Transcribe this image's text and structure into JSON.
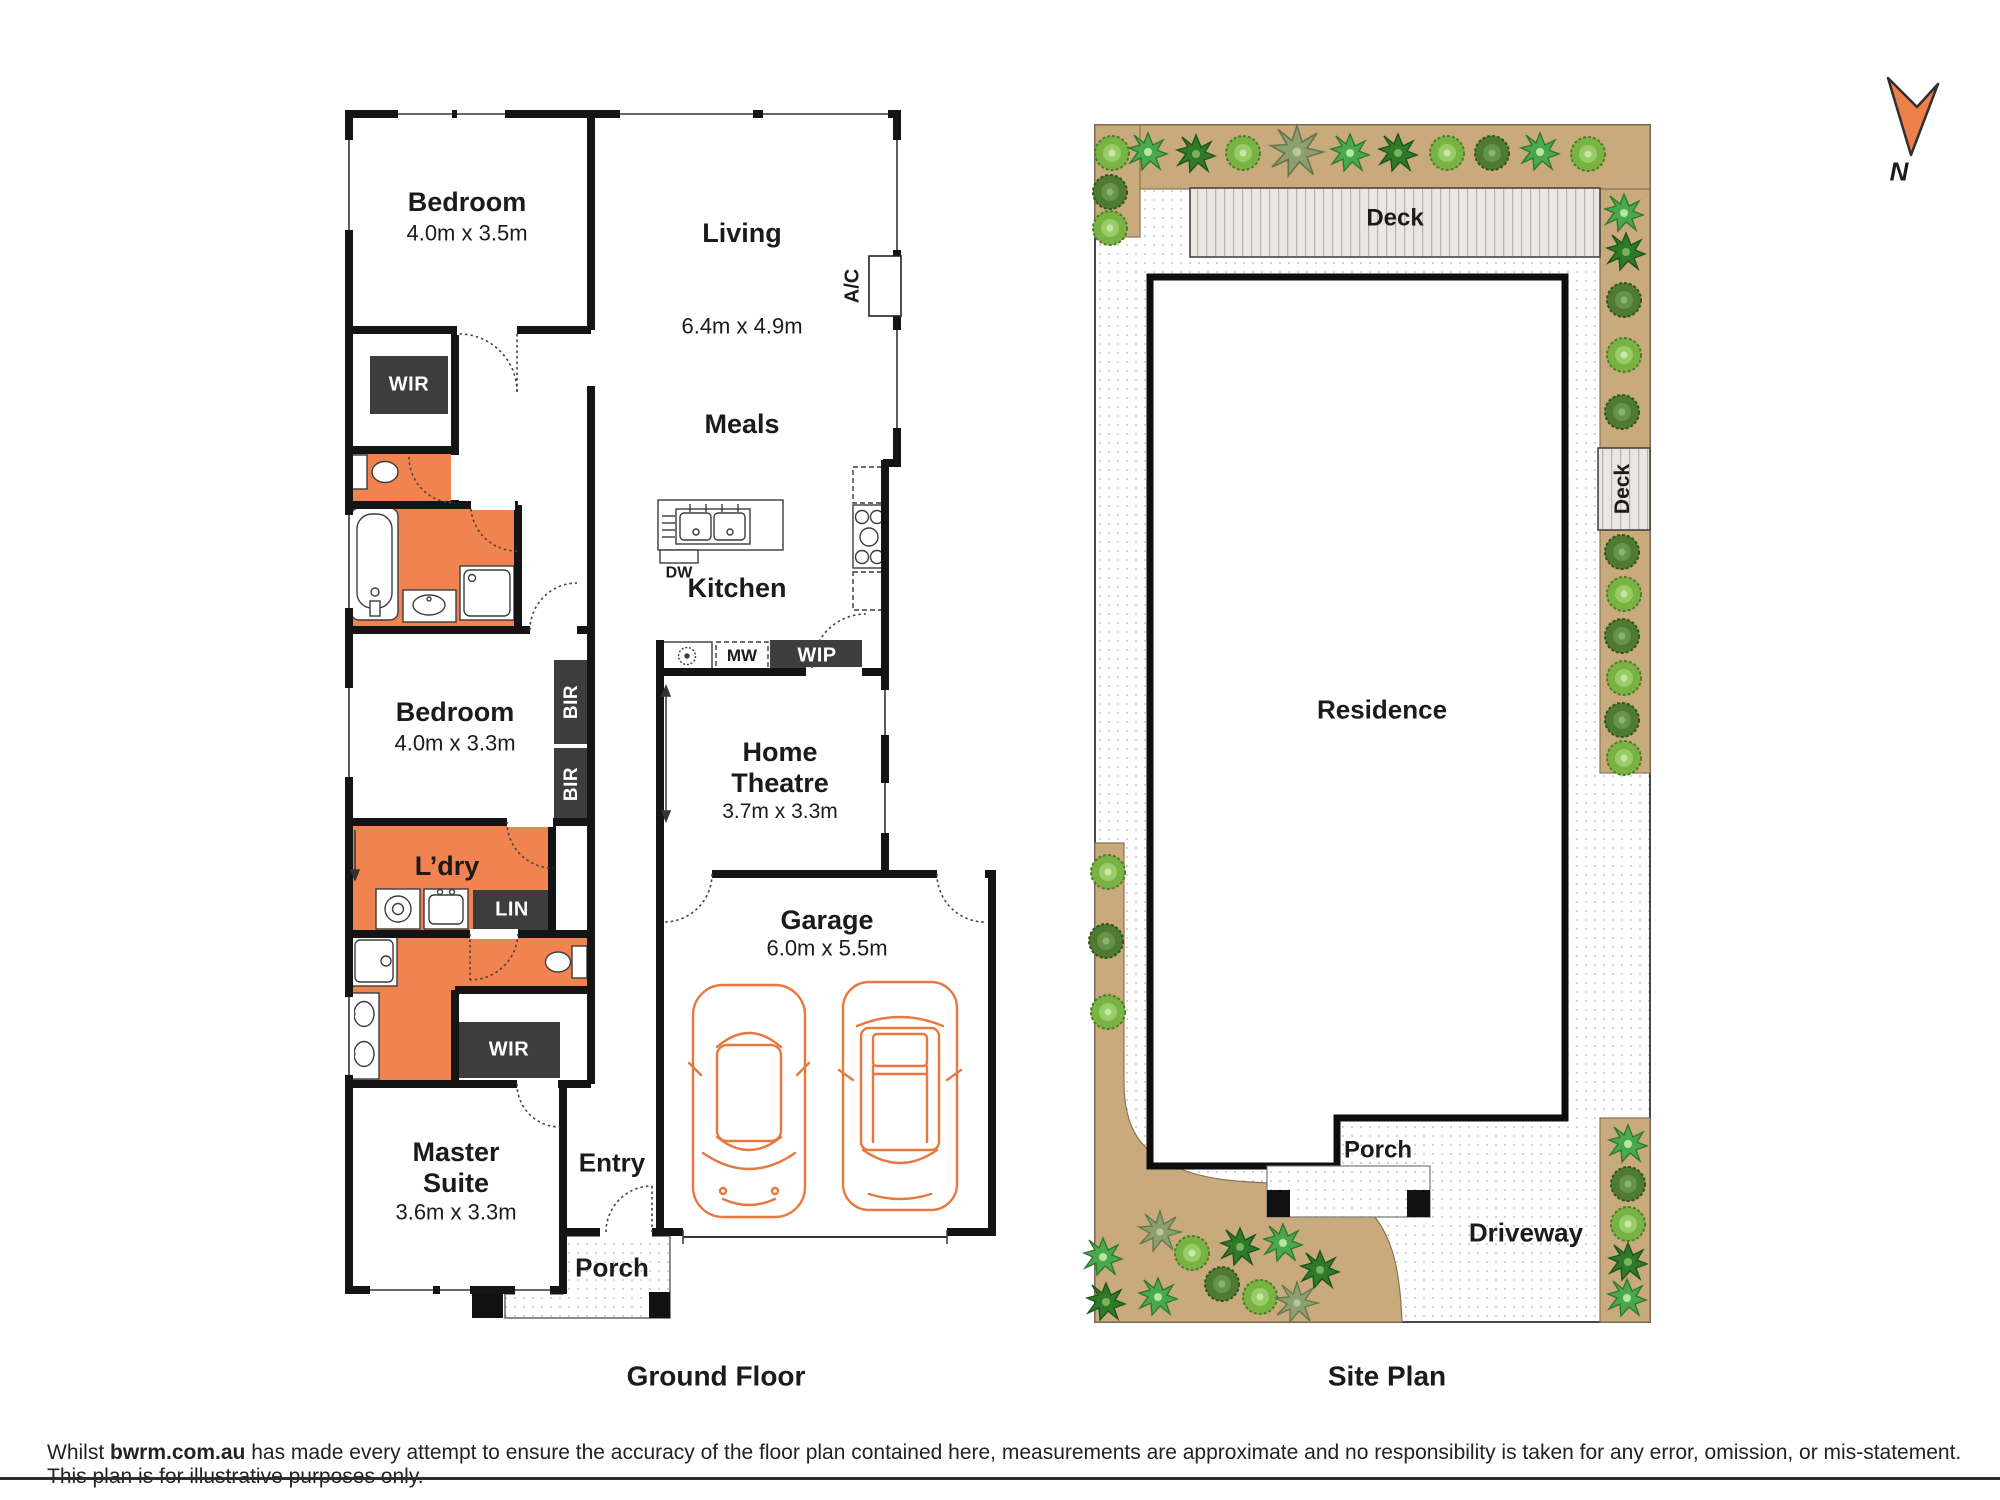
{
  "floor_plan": {
    "title": "Ground Floor",
    "rooms": {
      "bedroom1": {
        "name": "Bedroom",
        "dims": "4.0m x 3.5m"
      },
      "living": {
        "name": "Living",
        "dims": "6.4m x 4.9m"
      },
      "meals": {
        "name": "Meals"
      },
      "kitchen": {
        "name": "Kitchen"
      },
      "bedroom2": {
        "name": "Bedroom",
        "dims": "4.0m x 3.3m"
      },
      "laundry": {
        "name": "L’dry"
      },
      "home_theatre": {
        "name_line1": "Home",
        "name_line2": "Theatre",
        "dims": "3.7m x 3.3m"
      },
      "garage": {
        "name": "Garage",
        "dims": "6.0m x 5.5m"
      },
      "master_suite": {
        "name_line1": "Master",
        "name_line2": "Suite",
        "dims": "3.6m x 3.3m"
      },
      "entry": {
        "name": "Entry"
      },
      "porch": {
        "name": "Porch"
      }
    },
    "storage": {
      "wir1": "WIR",
      "wir2": "WIR",
      "bir1": "BIR",
      "bir2": "BIR",
      "lin": "LIN",
      "wip": "WIP"
    },
    "appliances": {
      "dw": "DW",
      "mw": "MW",
      "ac": "A/C"
    }
  },
  "site_plan": {
    "title": "Site Plan",
    "labels": {
      "deck_top": "Deck",
      "deck_side": "Deck",
      "residence": "Residence",
      "porch": "Porch",
      "driveway": "Driveway"
    }
  },
  "north_indicator": {
    "label": "N"
  },
  "footer": {
    "prefix": "Whilst",
    "brand": "bwrm.com.au",
    "text": "has made every attempt to ensure the accuracy of the floor plan contained here, measurements are approximate and no responsibility is taken for any error, omission, or mis-statement. This plan is for illustrative purposes only."
  },
  "colors": {
    "wet_area_orange": "#F0834F",
    "storage_dark": "#3D3D3D",
    "garden_tan": "#C9AA7D",
    "plant_green_light": "#79B344",
    "plant_green_dark": "#4E7A33",
    "car_outline_orange": "#E8793E",
    "north_arrow_orange": "#EF7F48"
  }
}
